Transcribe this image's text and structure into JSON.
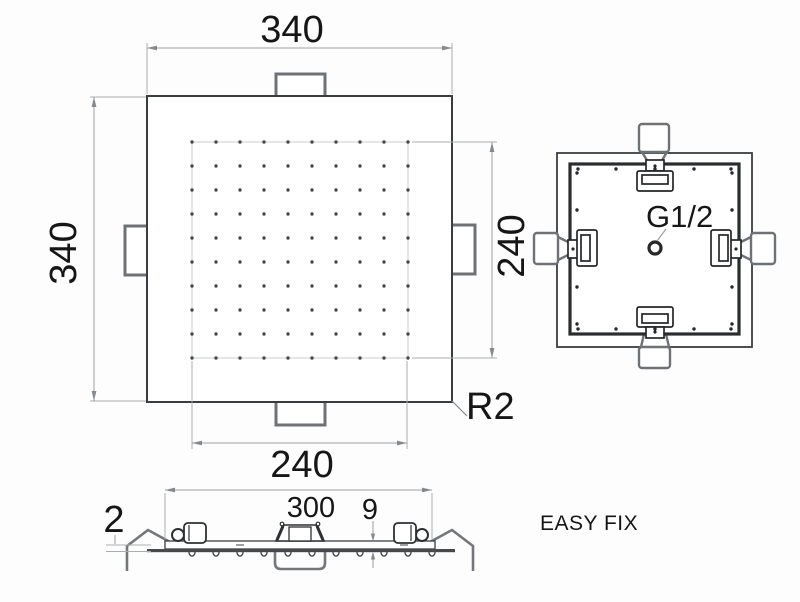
{
  "product": {
    "name": "EASY FIX"
  },
  "labels": {
    "brand": "EASY FIX",
    "thread_connection": "G1/2",
    "corner_radius": "R2"
  },
  "dimensions": {
    "overall_width": "340",
    "overall_height": "340",
    "spray_width": "240",
    "spray_height": "240",
    "body_width": "300",
    "body_thickness": "9",
    "plate_thickness": "2"
  }
}
